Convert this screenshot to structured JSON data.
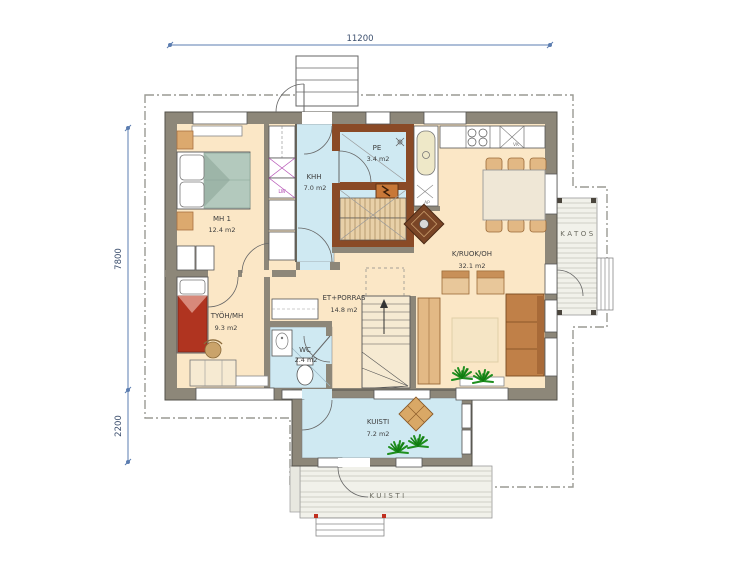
{
  "plan": {
    "dimensions": {
      "width": "11200",
      "depth_main": "7800",
      "depth_lower": "2200"
    },
    "rooms": {
      "mh1": {
        "name": "MH 1",
        "area": "12.4 m2"
      },
      "khh": {
        "name": "KHH",
        "area": "7.0 m2"
      },
      "pe": {
        "name": "PE",
        "area": "3.4 m2"
      },
      "tyoh": {
        "name": "TYÖH/MH",
        "area": "9.3 m2"
      },
      "wc": {
        "name": "WC",
        "area": "2.4 m2"
      },
      "et": {
        "name": "ET+PORRAS",
        "area": "14.8 m2"
      },
      "kroh": {
        "name": "K/RUOK/OH",
        "area": "32.1 m2"
      },
      "kuisti": {
        "name": "KUISTI",
        "area": "7.2 m2"
      }
    },
    "outdoor": {
      "katos": "KATOS",
      "porch": "KUISTI"
    },
    "tiny_labels": {
      "washer": "LW",
      "drain": "AP",
      "sink_unit": "VK"
    },
    "colors": {
      "wall": "#8d8779",
      "floor_dry": "#fbe7c6",
      "floor_wet": "#cfe9f2",
      "sauna_wall": "#8a4a26",
      "dim_line": "#5b7db0",
      "dim_text": "#3c4f6e",
      "bed_green": "#b3c9bd",
      "bed_red": "#b03420",
      "wood": "#d9a866",
      "sofa": "#c08048",
      "plant": "#1f8f1f",
      "appliance_mark": "#b44fb4"
    }
  }
}
